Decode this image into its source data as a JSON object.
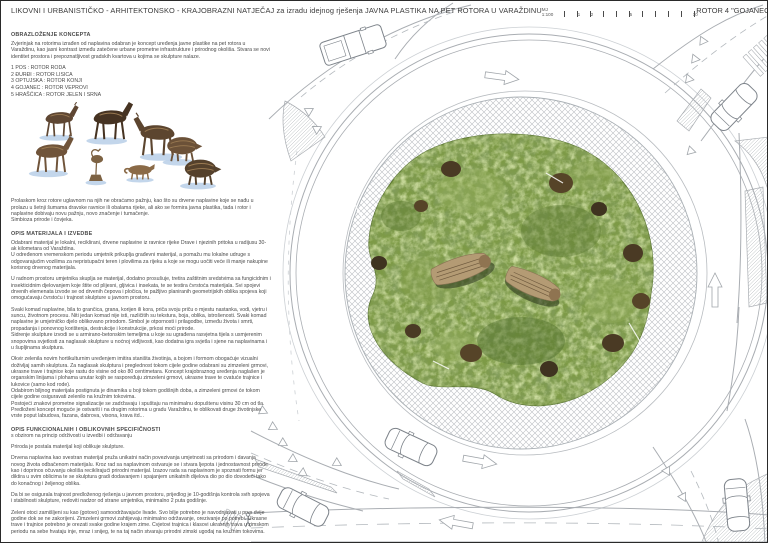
{
  "header": {
    "title": "LIKOVNI I URBANISTIČKO - ARHITEKTONSKO - KRAJOBRAZNI NATJEČAJ za izradu idejnog rješenja JAVNA PLASTIKA NA PET ROTORA U VARAŽDINU",
    "scale_label": "MJ 1:100",
    "scale_ticks": [
      "1",
      "2",
      "5",
      "10"
    ],
    "sheet_title": "ROTOR 4 \"GOJANEC\""
  },
  "left_column": {
    "section1": {
      "heading": "OBRAZLOŽENJE KONCEPTA",
      "paragraph": "Zvjerinjak na rotorima izrađen od naplavina odabran je koncept uređenja javne plastike na pet rotora u Varaždinu, kao jasni kontrast između zatečene urbane prometne infrastrukture i prirodnog okoliša. Stvara se novi identitet prostora i prepoznatljivost gradskih kvartova u kojima se skulpture nalaze.",
      "rotor_list": [
        "1 POS : ROTOR RODA",
        "2 ĐURĐI : ROTOR LISICA",
        "3 OPTUJSKA : ROTOR KONJI",
        "4 GOJANEC : ROTOR VEPROVI",
        "5 HRAŠĆICA : ROTOR JELEN I SRNA"
      ]
    },
    "intro_after_collage": "Prolaskom kroz rotore uglavnom na njih ne obraćamo pažnju, kao što su drvene naplavine koje se nađu u prolazu u šetnji šumama dravske ravnice ili obalama rijeke, ali ako se formira javna plastika, tada i rotor i naplavine dobivaju novu pažnju, novo značenje i tumačenje.\nSimbioza prirode i čovjeka.",
    "section2": {
      "heading": "OPIS MATERIJALA I IZVEDBE",
      "paragraphs": [
        "Odabrani materijal je lokalni, reciklirani, drvene naplavine iz ravnice rijeke Drave i njezinih pritoka u radijusu 30-ak kilometara od Varaždina.\nU određenom vremenskom periodu umjetnik prikuplja građevni materijal, a pomažu mu lokalne udruge s odgovarajućim vozilima za nepristupačni teren i plovilima za rijeku a koje se mogu uočiti veće ili manje nakupine korisnog drvenog materijala.",
        "U radnom prostoru umjetnika skuplja se materijal, dodatno prosušuje, tretira zaštitnim sredstvima sa fungicidnim i insekticidnim djelovanjem koje štite od plijesni, gljivica i insekata, te se testira čvrstoća materijala. Svi spojevi drvenih elemenata izvode se od drvenih čepova i pločica, te pažljivo planiranih geometrijskih oblika spojeva koji omogućavaju čvrstoću i trajnost skulpture u javnom prostoru.",
        "Svaki komad naplavine, bila to grančica, grana, korijen ili kora, priča svoju priču o mjestu nastanka, vodi, vjetru i suncu, životnom procesu. Niti jedan komad nije isti, različitih su tekstura, boja, oblika, istrošenosti. Svaki komad naplavine je umjetničko djelo oblikovano prirodom. Simbol je otpornosti i prilagodbe, između života i smrti, propadanja i ponovnog korištenja, destrukcije i konstrukcije, prkosi moći prirode.\nSidrenje skulpture izvodi se u armirano-betonskim temeljima u koje su ugrađena rasvjetna tijela s usmjerenim snopovima svjetlosti za naglasak skulpture u noćnoj vidljivosti, kao dodatna igra svjetla i sjene na naplavinama i u šupljinama skulptura.",
        "Okvir zelenila novim hortikulturnim uređenjem imitira staništa životinja, a bojom i formom obogaćuje vizualni doživljaj samih skulptura. Za naglasak skulptura i preglednost tokom cijele godine odabrani su zimzeleni grmovi, ukrasne trave i trajnice koje rastu do visine od oko 80 centimetara. Koncept krajobraznog uređenja naglašen je organskim linijama i plohama unutar kojih se raspoređuju zimzeleni grmovi, ukrasne trave te cvatuće trajnice i lukovice (samo kod rode).\nOdabirom biljnog materijala postignuta je dinamika u boji tokom godišnjih doba, a zimzeleni grmovi će tokom cijele godine osiguravati zelenilo na kružnim tokovima.\nPostojeći znakovi prometne signalizacije se zadržavaju i spuštaju na minimalnu dopuštenu visinu 30 cm od tla.\nPredloženi koncept moguće je ostvariti i na drugim rotorima u gradu Varaždinu, te oblikovati druge životinjske vrste poput labudova, fazana, dabrova, visona, krava itd..."
      ]
    },
    "section3": {
      "heading": "OPIS FUNKCIONALNIH I OBLIKOVNIH SPECIFIČNOSTI",
      "subheading": "s obzirom na princip održivosti u izvedbi i održavanju",
      "paragraphs": [
        "Priroda je postala materijal koji oblikuje skulpture.",
        "Drvena naplavina kao svestran materijal pruža unikatni način povezivanja umjetnosti sa prirodom i davanja novog života odbačenom materijalu. Kroz rad sa naplavinom ostvaruje se i stvara ljepota i jednostavnost prirode kao i doprinos očuvanju okoliša reciklirajući prirodni materijal. Izazov rada sa naplavinom je spoznati formu jer diktira u svim oblicima te se skulptura gradi dodavanjem i spajanjem unikatnih dijelova dio po dio dovodeći tako do konačnog i željenog oblika.",
        "Da bi se osigurala trajnost predloženog rješenja u javnom prostoru, prijedlog je 10-godišnja kontrola svih spojeva i stabilnosti skulpture, redoviti nadzor od strane umjetnika, minimalno 2 puta godišnje.",
        "Zeleni otoci zamišljeni su kao (gotovo) samoodržavajuće livade. Svo bilje potrebno je navodnjavati u prve dvije godine dok se ne zakorijeni. Zimzeleni grmovi zahtijevaju minimalno održavanje, orezivanje po potrebi. Ukrasne trave i trajnice potrebno je orezati svake godine krajem zime. Cvjetovi trajnica i klasovi ukrasnih trava u zimskom periodu na sebe hvataju inje, mraz i snijeg, te na taj način stvaraju prirodni zimski ugođaj na kružnim tokovima."
      ]
    }
  },
  "plan": {
    "description": "roundabout site plan with central green island, driftwood boar sculptures, truck apron, vehicles"
  },
  "colors": {
    "island_green": "#7d9a46",
    "island_green_dark": "#5c7733",
    "shrub_brown": "#4a3a24",
    "driftwood_brown": "#6b4f35",
    "driftwood_light": "#b49b74",
    "shadow_blue": "#b9cfe8",
    "plan_line": "#a9adb2"
  }
}
